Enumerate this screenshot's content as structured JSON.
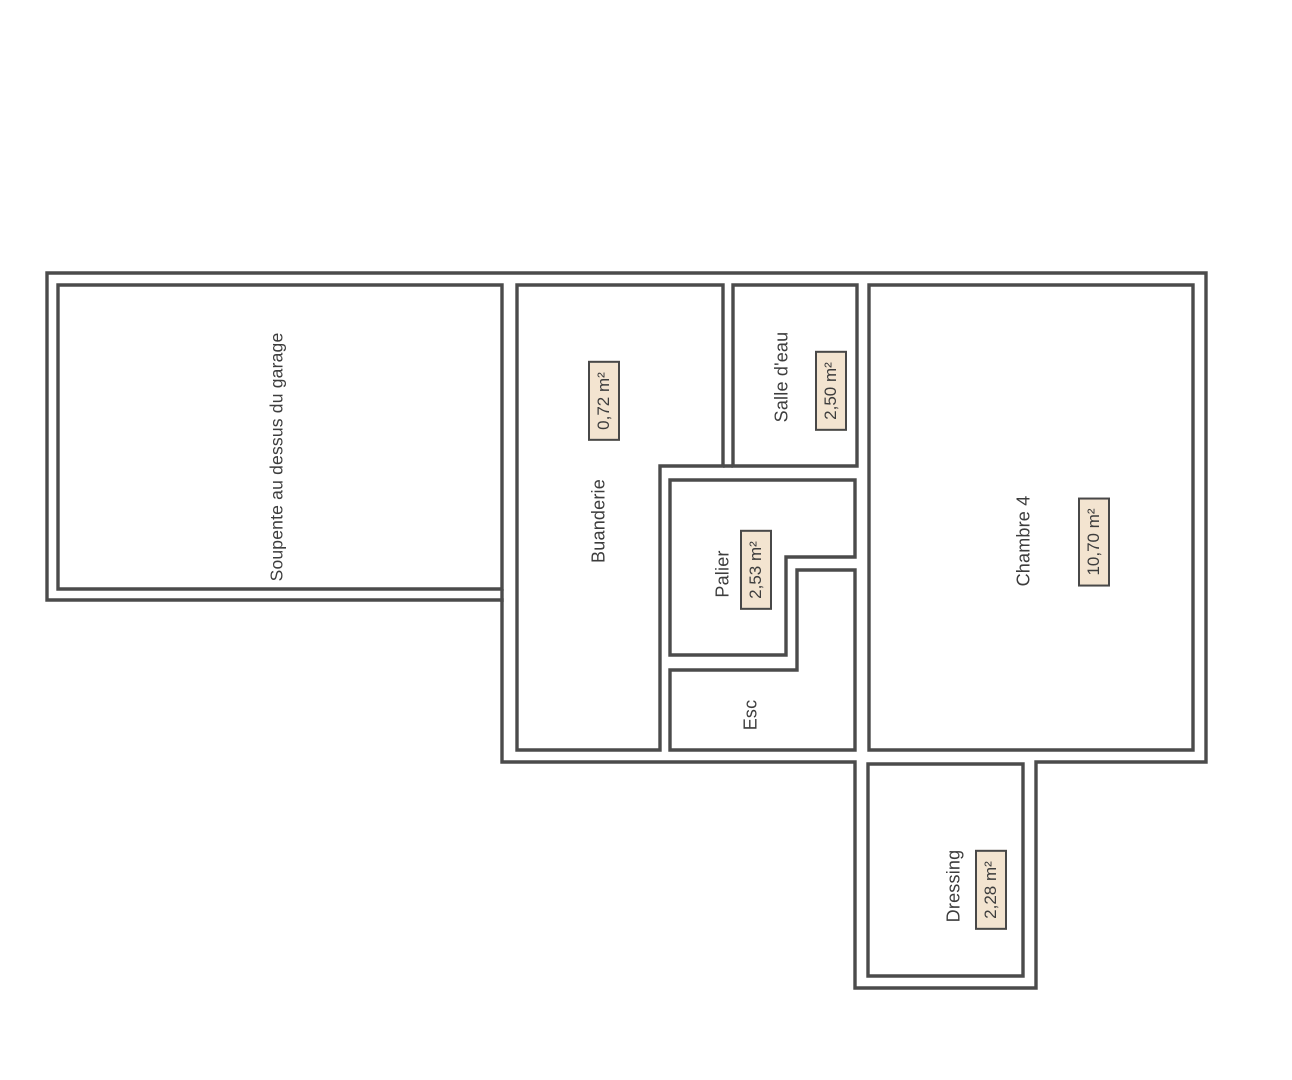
{
  "document": {
    "type": "floor-plan",
    "background": "#ffffff"
  },
  "colors": {
    "wall": "#4b4b4b",
    "label_text": "#3d3d3d",
    "area_badge_fill": "#f3e4d0",
    "area_badge_border": "#484848",
    "background": "#ffffff"
  },
  "rooms": [
    {
      "id": "soupente",
      "label": "Soupente au dessus du garage",
      "label_center": {
        "x": 277,
        "y": 457
      },
      "area": null
    },
    {
      "id": "buanderie",
      "label": "Buanderie",
      "label_center": {
        "x": 599,
        "y": 521
      },
      "area": "0,72 m²",
      "area_center": {
        "x": 604,
        "y": 401
      }
    },
    {
      "id": "salle-deau",
      "label": "Salle d'eau",
      "label_center": {
        "x": 782,
        "y": 377
      },
      "area": "2,50 m²",
      "area_center": {
        "x": 831,
        "y": 391
      }
    },
    {
      "id": "palier",
      "label": "Palier",
      "label_center": {
        "x": 723,
        "y": 574
      },
      "area": "2,53 m²",
      "area_center": {
        "x": 756,
        "y": 570
      }
    },
    {
      "id": "esc",
      "label": "Esc",
      "label_center": {
        "x": 751,
        "y": 715
      },
      "area": null
    },
    {
      "id": "chambre-4",
      "label": "Chambre 4",
      "label_center": {
        "x": 1024,
        "y": 541
      },
      "area": "10,70 m²",
      "area_center": {
        "x": 1094,
        "y": 542
      }
    },
    {
      "id": "dressing",
      "label": "Dressing",
      "label_center": {
        "x": 954,
        "y": 886
      },
      "area": "2,28 m²",
      "area_center": {
        "x": 991,
        "y": 890
      }
    }
  ]
}
